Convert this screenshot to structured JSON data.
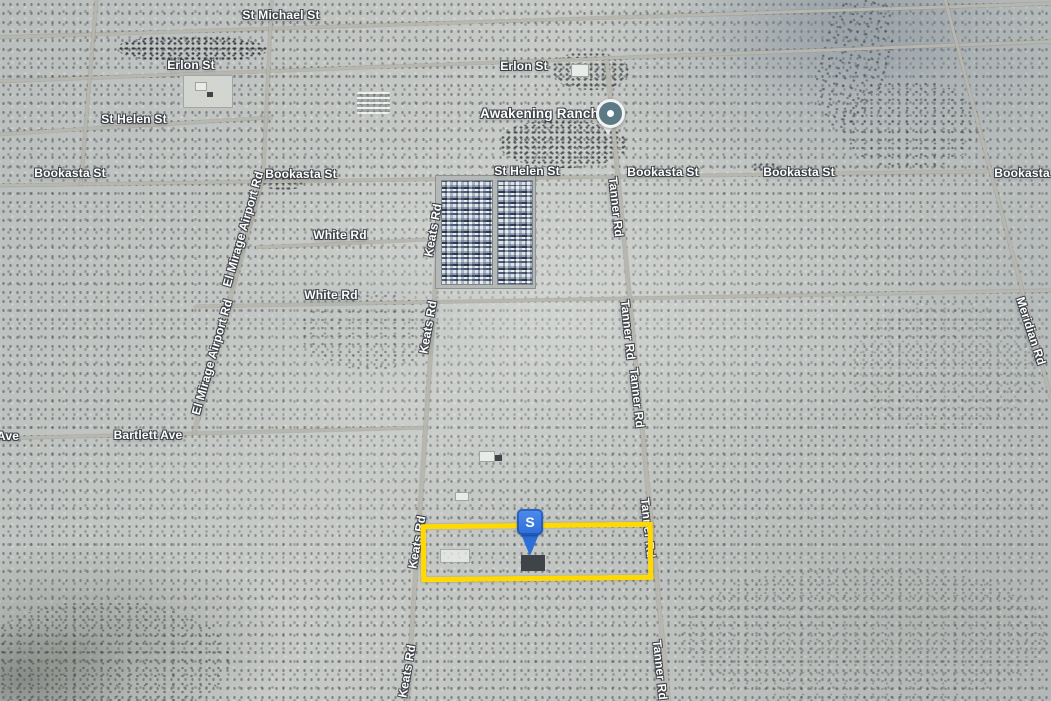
{
  "poi": {
    "name": "Awakening Ranch"
  },
  "marker": {
    "label": "S"
  },
  "property_outline": {
    "color": "#FFD900"
  },
  "colors": {
    "terrain_base": "#c5c8c4",
    "road": "#b8b7af",
    "label_text": "#ffffff",
    "label_outline": "#3a3e44",
    "marker_blue": "#2d6fd9",
    "poi_pin_fill": "#5b7a86",
    "outline_yellow": "#FFD900"
  },
  "street_labels": [
    {
      "id": "st-michael-st",
      "text": "St Michael St",
      "x": 281,
      "y": 15,
      "rot": 0
    },
    {
      "id": "erlon-st-w",
      "text": "Erlon St",
      "x": 191,
      "y": 65,
      "rot": 0
    },
    {
      "id": "erlon-st-e",
      "text": "Erlon St",
      "x": 524,
      "y": 66,
      "rot": 0
    },
    {
      "id": "st-helen-st-w",
      "text": "St Helen St",
      "x": 134,
      "y": 119,
      "rot": 0
    },
    {
      "id": "st-helen-st-c",
      "text": "St Helen St",
      "x": 527,
      "y": 171,
      "rot": 0
    },
    {
      "id": "bookasta-st-1",
      "text": "Bookasta St",
      "x": 70,
      "y": 173,
      "rot": 0
    },
    {
      "id": "bookasta-st-2",
      "text": "Bookasta St",
      "x": 301,
      "y": 174,
      "rot": 0
    },
    {
      "id": "bookasta-st-3",
      "text": "Bookasta St",
      "x": 663,
      "y": 172,
      "rot": 0
    },
    {
      "id": "bookasta-st-4",
      "text": "Bookasta St",
      "x": 799,
      "y": 172,
      "rot": 0
    },
    {
      "id": "bookasta-st-5",
      "text": "Bookasta St",
      "x": 1030,
      "y": 173,
      "rot": 0
    },
    {
      "id": "white-rd-n",
      "text": "White Rd",
      "x": 340,
      "y": 235,
      "rot": 0
    },
    {
      "id": "white-rd-s",
      "text": "White Rd",
      "x": 331,
      "y": 295,
      "rot": 0
    },
    {
      "id": "bartlett-ave",
      "text": "Bartlett Ave",
      "x": 148,
      "y": 435,
      "rot": 0
    },
    {
      "id": "ave-partial",
      "text": "Ave",
      "x": 8,
      "y": 436,
      "rot": 0
    },
    {
      "id": "el-mirage-airport-rd-n",
      "text": "El Mirage Airport Rd",
      "x": 243,
      "y": 229,
      "rot": -74
    },
    {
      "id": "el-mirage-airport-rd-s",
      "text": "El Mirage Airport Rd",
      "x": 212,
      "y": 357,
      "rot": -74
    },
    {
      "id": "keats-rd-1",
      "text": "Keats Rd",
      "x": 433,
      "y": 230,
      "rot": -80
    },
    {
      "id": "keats-rd-2",
      "text": "Keats Rd",
      "x": 428,
      "y": 327,
      "rot": -80
    },
    {
      "id": "keats-rd-3",
      "text": "Keats Rd",
      "x": 417,
      "y": 542,
      "rot": -80
    },
    {
      "id": "keats-rd-4",
      "text": "Keats Rd",
      "x": 407,
      "y": 671,
      "rot": -80
    },
    {
      "id": "tanner-rd-1",
      "text": "Tanner Rd",
      "x": 616,
      "y": 207,
      "rot": 84
    },
    {
      "id": "tanner-rd-2",
      "text": "Tanner Rd",
      "x": 628,
      "y": 330,
      "rot": 84
    },
    {
      "id": "tanner-rd-3",
      "text": "Tanner Rd",
      "x": 637,
      "y": 398,
      "rot": 84
    },
    {
      "id": "tanner-rd-4",
      "text": "Tanner Rd",
      "x": 648,
      "y": 528,
      "rot": 84
    },
    {
      "id": "tanner-rd-5",
      "text": "Tanner Rd",
      "x": 660,
      "y": 670,
      "rot": 84
    },
    {
      "id": "meridian-rd",
      "text": "Meridian Rd",
      "x": 1031,
      "y": 331,
      "rot": 72
    }
  ],
  "roads": [
    {
      "id": "road-st-michael",
      "x1": -5,
      "y1": 37,
      "x2": 1051,
      "y2": 3,
      "w": 3
    },
    {
      "id": "road-erlon",
      "x1": -5,
      "y1": 81,
      "x2": 1051,
      "y2": 41,
      "w": 3
    },
    {
      "id": "road-st-helen-w",
      "x1": -5,
      "y1": 134,
      "x2": 272,
      "y2": 117,
      "w": 2.5
    },
    {
      "id": "road-bookasta",
      "x1": -5,
      "y1": 185,
      "x2": 1051,
      "y2": 170,
      "w": 3
    },
    {
      "id": "road-white-n",
      "x1": 256,
      "y1": 247,
      "x2": 428,
      "y2": 239,
      "w": 2.5
    },
    {
      "id": "road-white-s",
      "x1": 194,
      "y1": 306,
      "x2": 1051,
      "y2": 290,
      "w": 2.5
    },
    {
      "id": "road-bartlett",
      "x1": -5,
      "y1": 438,
      "x2": 430,
      "y2": 427,
      "w": 2.5
    },
    {
      "id": "road-left-vert",
      "x1": 97,
      "y1": -5,
      "x2": 81,
      "y2": 185,
      "w": 2.5
    },
    {
      "id": "road-el-mirage-n",
      "x1": 272,
      "y1": -5,
      "x2": 263,
      "y2": 178,
      "w": 3
    },
    {
      "id": "road-el-mirage-s",
      "x1": 263,
      "y1": 178,
      "x2": 194,
      "y2": 434,
      "w": 3.5
    },
    {
      "id": "road-keats",
      "x1": 443,
      "y1": 176,
      "x2": 407,
      "y2": 705,
      "w": 3.5
    },
    {
      "id": "road-tanner",
      "x1": 607,
      "y1": 60,
      "x2": 669,
      "y2": 705,
      "w": 3.5
    },
    {
      "id": "road-meridian",
      "x1": 944,
      "y1": -5,
      "x2": 1051,
      "y2": 398,
      "w": 3
    }
  ]
}
